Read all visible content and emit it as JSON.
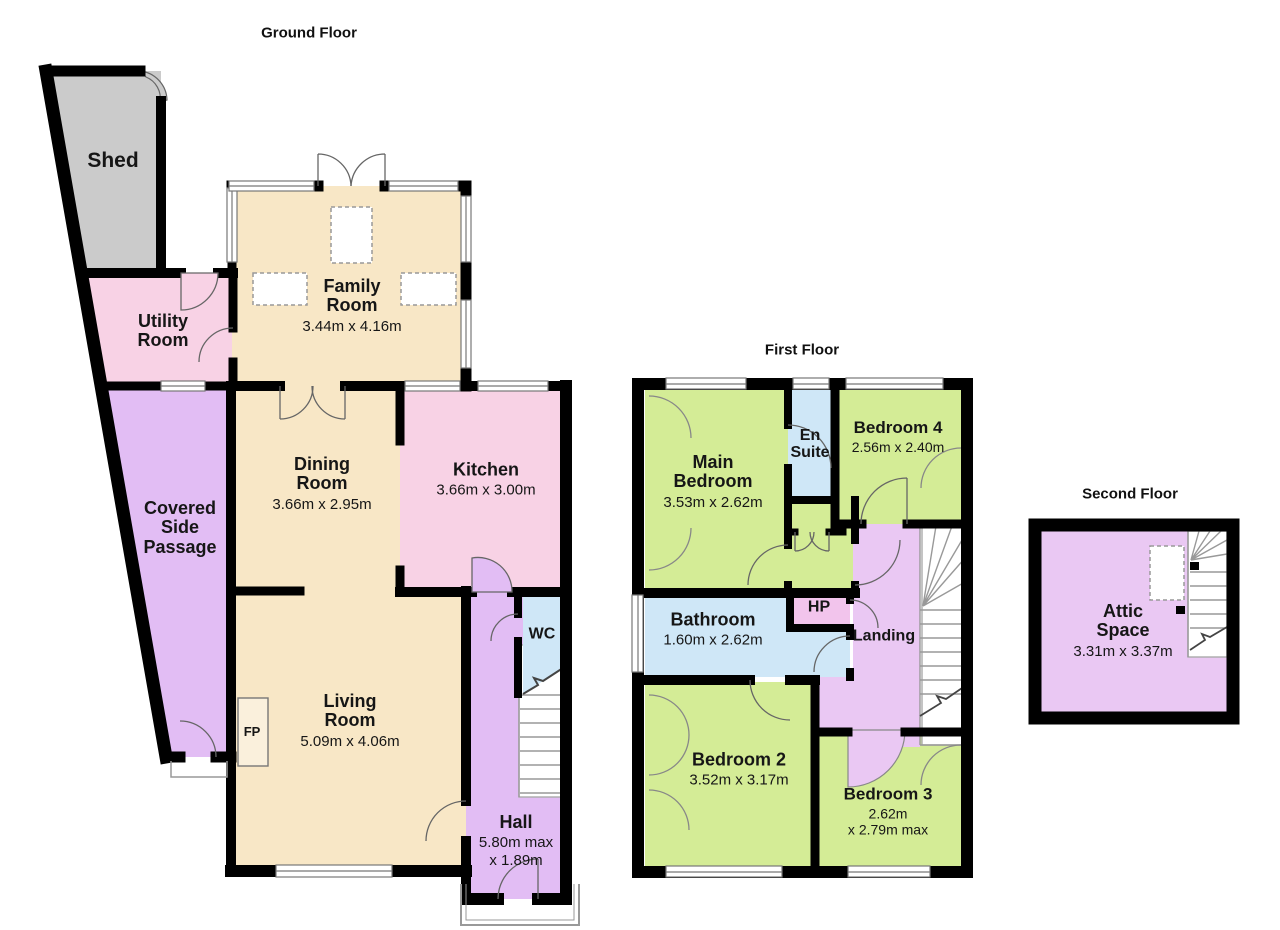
{
  "titles": {
    "ground": "Ground Floor",
    "first": "First Floor",
    "second": "Second Floor"
  },
  "rooms": {
    "shed": {
      "name": "Shed"
    },
    "utility": {
      "name": "Utility Room"
    },
    "passage": {
      "name": "Covered Side Passage"
    },
    "family": {
      "name": "Family Room",
      "dims": "3.44m x 4.16m"
    },
    "dining": {
      "name": "Dining Room",
      "dims": "3.66m x 2.95m"
    },
    "kitchen": {
      "name": "Kitchen",
      "dims": "3.66m x 3.00m"
    },
    "living": {
      "name": "Living Room",
      "dims": "5.09m x 4.06m"
    },
    "wc": {
      "name": "WC"
    },
    "hall": {
      "name": "Hall",
      "dims1": "5.80m max",
      "dims2": "x 1.89m"
    },
    "fp": {
      "name": "FP"
    },
    "main_bedroom": {
      "name": "Main Bedroom",
      "dims": "3.53m x 2.62m"
    },
    "en_suite": {
      "name": "En Suite"
    },
    "bedroom4": {
      "name": "Bedroom 4",
      "dims": "2.56m x 2.40m"
    },
    "bathroom": {
      "name": "Bathroom",
      "dims": "1.60m x 2.62m"
    },
    "hp": {
      "name": "HP"
    },
    "landing": {
      "name": "Landing"
    },
    "bedroom2": {
      "name": "Bedroom 2",
      "dims": "3.52m x 3.17m"
    },
    "bedroom3": {
      "name": "Bedroom 3",
      "dims1": "2.62m",
      "dims2": "x 2.79m max"
    },
    "attic": {
      "name": "Attic Space",
      "dims": "3.31m x 3.37m"
    }
  },
  "colors": {
    "wall": "#000000",
    "reception_cream": "#f8e7c6",
    "kitchen_pink": "#f8d2e5",
    "circulation_purple": "#e2bdf4",
    "landing_purple": "#eac8f3",
    "bedroom_green": "#d4ec96",
    "bath_blue": "#cfe7f7",
    "shed_grey": "#cbcbcb",
    "hp_pink": "#f2c4ec"
  }
}
